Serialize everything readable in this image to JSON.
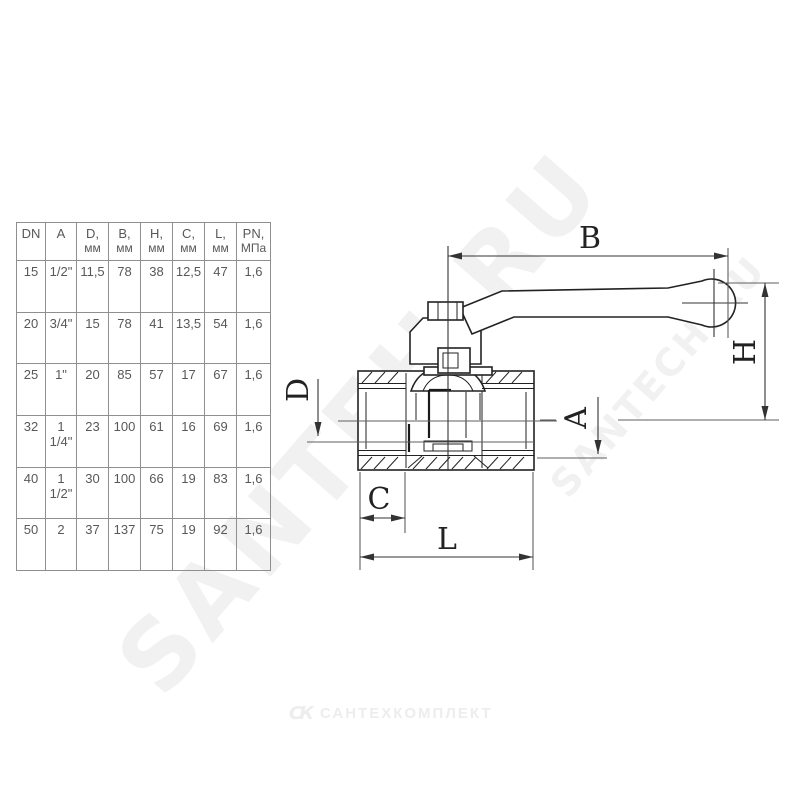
{
  "colors": {
    "background": "#ffffff",
    "drawing_line": "#222222",
    "reference_line": "#5f5f5f",
    "table_border": "#8f8f8f",
    "table_text": "#585858",
    "watermark_text": "#000000",
    "footer_logo": "#ededed"
  },
  "table": {
    "columns": [
      {
        "label": "DN",
        "sub": ""
      },
      {
        "label": "A",
        "sub": ""
      },
      {
        "label": "D,",
        "sub": "мм"
      },
      {
        "label": "B,",
        "sub": "мм"
      },
      {
        "label": "H,",
        "sub": "мм"
      },
      {
        "label": "C,",
        "sub": "мм"
      },
      {
        "label": "L,",
        "sub": "мм"
      },
      {
        "label": "PN,",
        "sub": "МПа"
      }
    ],
    "rows": [
      [
        "15",
        "1/2\"",
        "11,5",
        "78",
        "38",
        "12,5",
        "47",
        "1,6"
      ],
      [
        "20",
        "3/4\"",
        "15",
        "78",
        "41",
        "13,5",
        "54",
        "1,6"
      ],
      [
        "25",
        "1\"",
        "20",
        "85",
        "57",
        "17",
        "67",
        "1,6"
      ],
      [
        "32",
        "1\n1/4\"",
        "23",
        "100",
        "61",
        "16",
        "69",
        "1,6"
      ],
      [
        "40",
        "1\n1/2\"",
        "30",
        "100",
        "66",
        "19",
        "83",
        "1,6"
      ],
      [
        "50",
        "2",
        "37",
        "137",
        "75",
        "19",
        "92",
        "1,6"
      ]
    ]
  },
  "drawing": {
    "labels": {
      "b": "B",
      "h": "H",
      "d": "D",
      "a": "A",
      "c": "C",
      "l": "L"
    }
  },
  "watermarks": {
    "large": "SANTEH.RU",
    "small": "SANTECH.RU"
  },
  "footer": {
    "logo_mark": "СК",
    "logo_text": "САНТЕХКОМПЛЕКТ"
  }
}
